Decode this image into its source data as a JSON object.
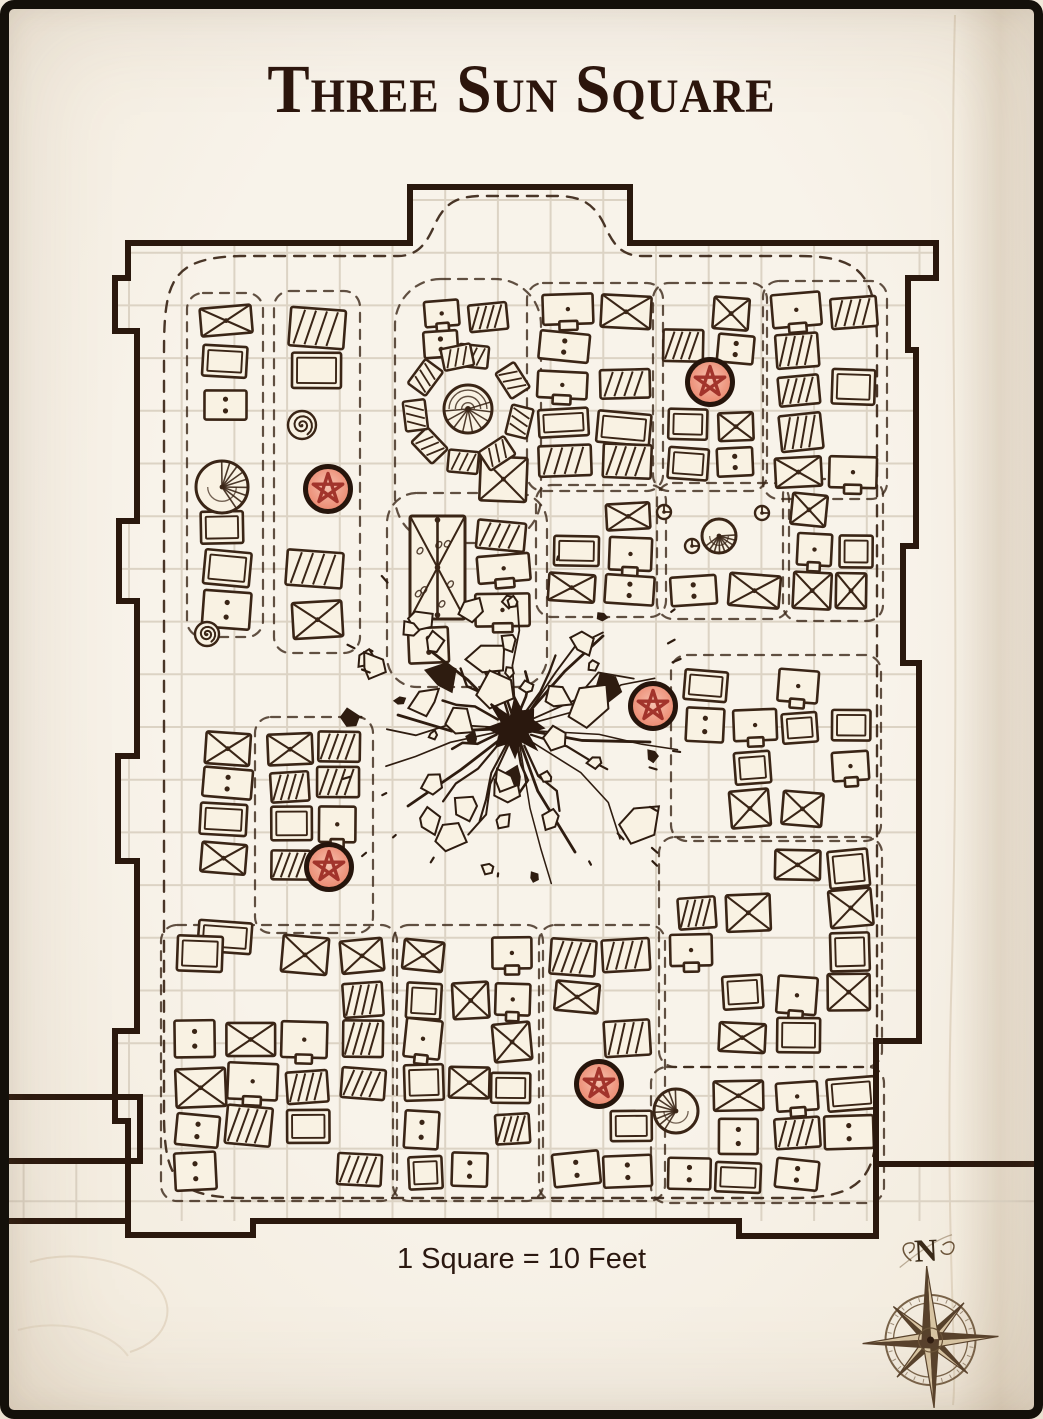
{
  "page": {
    "title": "Three Sun Square",
    "scale_label": "1 Square = 10 Feet",
    "background": "#f5efe6",
    "frame_color": "#14100a",
    "title_color": "#2c160d",
    "text_color": "#2b1810"
  },
  "map": {
    "ink": "#3a2516",
    "wall_ink": "#2a180d",
    "grid_color": "#dcd3c4",
    "stall_fill": "#f9f2e3",
    "grid": {
      "cell": 52.7,
      "x0": 129,
      "y0": 200,
      "cols_from": -2,
      "cols_to": 15,
      "rows_to": 19
    },
    "clip_points": "128,243 410,243 410,187 630,187 630,243 936,243 936,278 908,278 908,350 916,350 916,546 903,546 903,663 919,663 919,1041 876,1041 876,1164 1043,1164 1043,1221 0,1221 0,1161 128,1161 128,1121 115,1121 115,1031 137,1031 137,861 118,861 118,756 137,756 137,601 119,601 119,521 137,521 137,331 115,331 115,278 128,278",
    "walls": [
      "M128,243 H410 V187 H630 V243 H936",
      "M936,243 V278 H908 V350 H916 V546 H903 V663 H919 V1041 H876 V1164 H1043",
      "M128,243 V278 H115 V331 H137 V521 H119 V601 H137 V756 H118 V861 H137 V1031 H115 V1121 H128 V1221",
      "M6,1221 H128 V1235 H253 V1221 H739 V1236 H876 V1164",
      "M0,1097 H140 V1161 H0"
    ],
    "boundary": "M164,352 C164,280 172,258 240,256 H398 C420,256 428,240 436,222 C446,202 458,197 478,196 H560 C582,197 594,204 604,224 C612,242 620,256 642,256 H798 C860,256 876,274 877,340 V1118 C877,1180 858,1197 796,1198 H242 C176,1197 165,1178 164,1118 Z",
    "markers": {
      "radius": 22.5,
      "ring": "#26150c",
      "star": "#9d2d26",
      "grad_in": "#f6c2b0",
      "grad_mid": "#ee9780",
      "grad_out": "#e87f63",
      "positions": [
        [
          710,
          382
        ],
        [
          328,
          489
        ],
        [
          653,
          706
        ],
        [
          329,
          867
        ],
        [
          599,
          1084
        ]
      ]
    },
    "explosion": {
      "x": 515,
      "y": 728
    },
    "canopy": {
      "x": 468,
      "y": 409,
      "r": 24
    },
    "awning": {
      "x": 410,
      "y": 516,
      "w": 55,
      "h": 103
    },
    "fans": [
      [
        222,
        487,
        26
      ],
      [
        719,
        536,
        17
      ],
      [
        676,
        1111,
        22
      ]
    ],
    "spirals": [
      [
        302,
        425,
        11
      ],
      [
        207,
        634,
        9
      ]
    ],
    "circles": [
      [
        762,
        513,
        7
      ],
      [
        692,
        546,
        7
      ],
      [
        664,
        512,
        7
      ]
    ],
    "extra_outlines": [
      {
        "x": 404,
        "y": 288,
        "w": 128,
        "h": 246,
        "rx": 46
      },
      {
        "x": 396,
        "y": 502,
        "w": 142,
        "h": 176,
        "rx": 30
      }
    ],
    "blocks": [
      {
        "x": 196,
        "y": 302,
        "w": 58,
        "h": 326,
        "c": 1,
        "r": 8,
        "s": 0.15,
        "o": 1
      },
      {
        "x": 283,
        "y": 300,
        "w": 68,
        "h": 344,
        "c": 1,
        "r": 7,
        "s": 0.12,
        "o": 1
      },
      {
        "x": 196,
        "y": 726,
        "w": 58,
        "h": 232,
        "c": 1,
        "r": 6,
        "s": 0.18,
        "o": 0
      },
      {
        "x": 264,
        "y": 726,
        "w": 100,
        "h": 198,
        "c": 2,
        "r": 5,
        "s": 0.22,
        "o": 1
      },
      {
        "x": 170,
        "y": 934,
        "w": 218,
        "h": 258,
        "c": 4,
        "r": 6,
        "s": 0.3,
        "o": 1
      },
      {
        "x": 420,
        "y": 298,
        "w": 92,
        "h": 66,
        "c": 2,
        "r": 2,
        "s": 0.3,
        "o": 0
      },
      {
        "x": 424,
        "y": 456,
        "w": 104,
        "h": 52,
        "c": 2,
        "r": 1,
        "s": 0.25,
        "o": 0
      },
      {
        "x": 536,
        "y": 292,
        "w": 118,
        "h": 190,
        "c": 2,
        "r": 5,
        "s": 0.2,
        "o": 1
      },
      {
        "x": 662,
        "y": 292,
        "w": 96,
        "h": 190,
        "c": 2,
        "r": 5,
        "s": 0.22,
        "o": 1
      },
      {
        "x": 772,
        "y": 290,
        "w": 106,
        "h": 200,
        "c": 2,
        "r": 5,
        "s": 0.22,
        "o": 1
      },
      {
        "x": 545,
        "y": 494,
        "w": 112,
        "h": 114,
        "c": 2,
        "r": 3,
        "s": 0.25,
        "o": 1
      },
      {
        "x": 666,
        "y": 492,
        "w": 114,
        "h": 118,
        "c": 2,
        "r": 3,
        "s": 0.3,
        "o": 1
      },
      {
        "x": 792,
        "y": 488,
        "w": 82,
        "h": 124,
        "c": 2,
        "r": 3,
        "s": 0.25,
        "o": 1
      },
      {
        "x": 680,
        "y": 664,
        "w": 192,
        "h": 168,
        "c": 4,
        "r": 4,
        "s": 0.26,
        "o": 1
      },
      {
        "x": 668,
        "y": 846,
        "w": 205,
        "h": 212,
        "c": 4,
        "r": 5,
        "s": 0.28,
        "o": 1
      },
      {
        "x": 660,
        "y": 1076,
        "w": 215,
        "h": 118,
        "c": 4,
        "r": 3,
        "s": 0.32,
        "o": 1
      },
      {
        "x": 402,
        "y": 934,
        "w": 132,
        "h": 258,
        "c": 3,
        "r": 6,
        "s": 0.28,
        "o": 1
      },
      {
        "x": 548,
        "y": 934,
        "w": 108,
        "h": 258,
        "c": 2,
        "r": 6,
        "s": 0.28,
        "o": 1
      },
      {
        "x": 470,
        "y": 514,
        "w": 62,
        "h": 112,
        "c": 1,
        "r": 3,
        "s": 0.1,
        "o": 0
      },
      {
        "x": 402,
        "y": 620,
        "w": 104,
        "h": 50,
        "c": 2,
        "r": 1,
        "s": 0.2,
        "o": 0
      }
    ]
  },
  "compass": {
    "label": "N",
    "x": 930,
    "y": 1340
  }
}
